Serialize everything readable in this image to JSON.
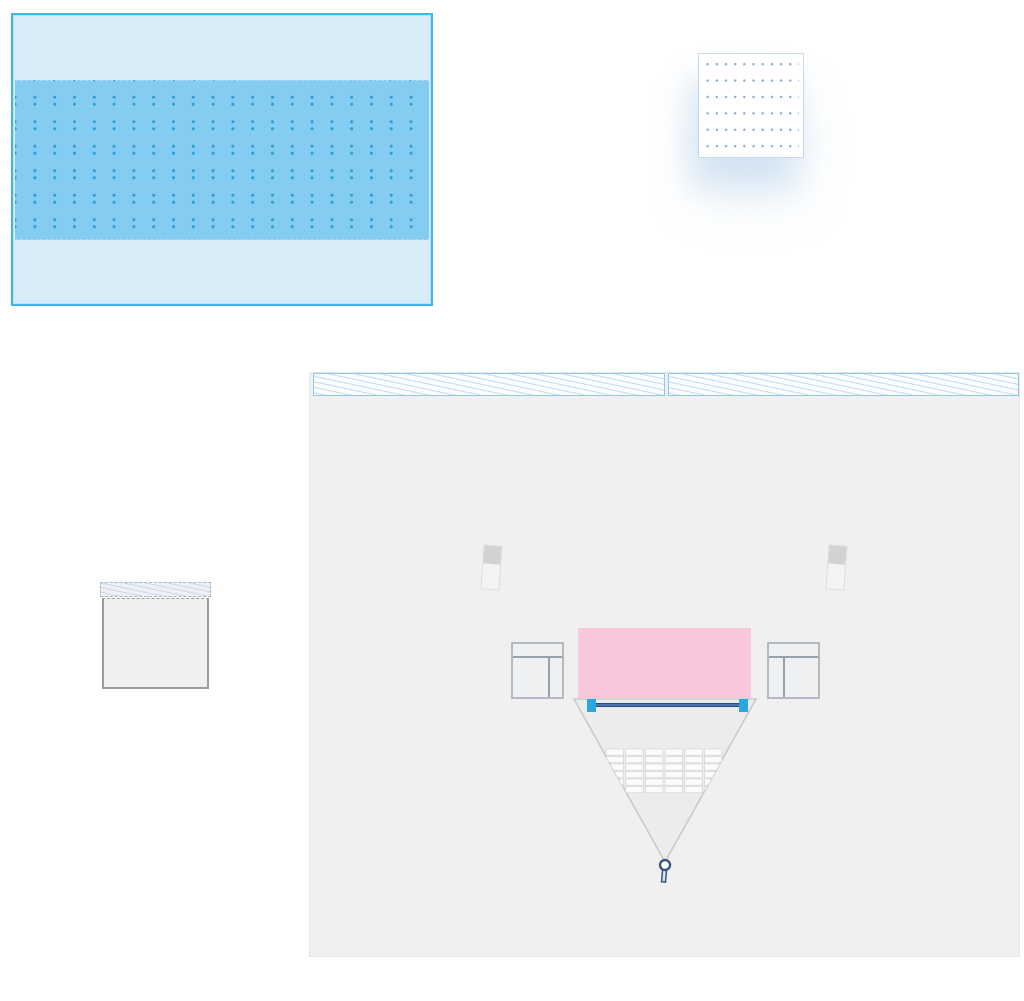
{
  "app": {
    "view": "venue-layout-canvas",
    "background": "#ffffff"
  },
  "colors": {
    "pool_fill": "#d9edf9",
    "pool_border": "#3fb5e8",
    "pool_band": "#84ccf0",
    "pool_dot": "#2b9fd8",
    "panel_fill": "#ffffff",
    "panel_border": "#c5daec",
    "panel_dot": "#8db2d5",
    "area_fill": "#f0f0f0",
    "area_edge": "#dcdcdc",
    "hatch_fill": "#fbfdff",
    "hatch_border": "#92c8e9",
    "hatch_line": "#c6e1f3",
    "equip_band_fill": "#edf1f6",
    "equip_band_border": "#a9bac9",
    "equip_band_line": "#ccd7e2",
    "equip_body_fill": "#f0f0f0",
    "equip_body_border": "#999da1",
    "stage_pink": "#f9c7db",
    "table_fill": "#eef0f1",
    "table_border": "#b3b9bf",
    "table_line": "#99a1a8",
    "speaker_body": "#f3f3f4",
    "speaker_top": "#d2d2d4",
    "speaker_border": "#dcdddd",
    "funnel_fill": "#ececec",
    "funnel_stroke": "#c8cacc",
    "seat_fill": "#fafbfb",
    "seat_stroke": "#d2d5d8",
    "net_bar": "#2b4a7e",
    "net_bar_core": "#6f9bd0",
    "net_cap": "#2aa6e0",
    "pin_stroke": "#3b5781",
    "pin_fill": "#ffffff",
    "pin_stem": "#dde1e6"
  },
  "pool": {
    "dot_columns": 21,
    "dot_row_pairs": 6
  },
  "dotted_panel": {
    "dot_columns": 11,
    "dot_rows": 6
  },
  "stage_area": {
    "hatch_strips": 2,
    "seating": {
      "rows": 6,
      "cols": 6
    }
  }
}
